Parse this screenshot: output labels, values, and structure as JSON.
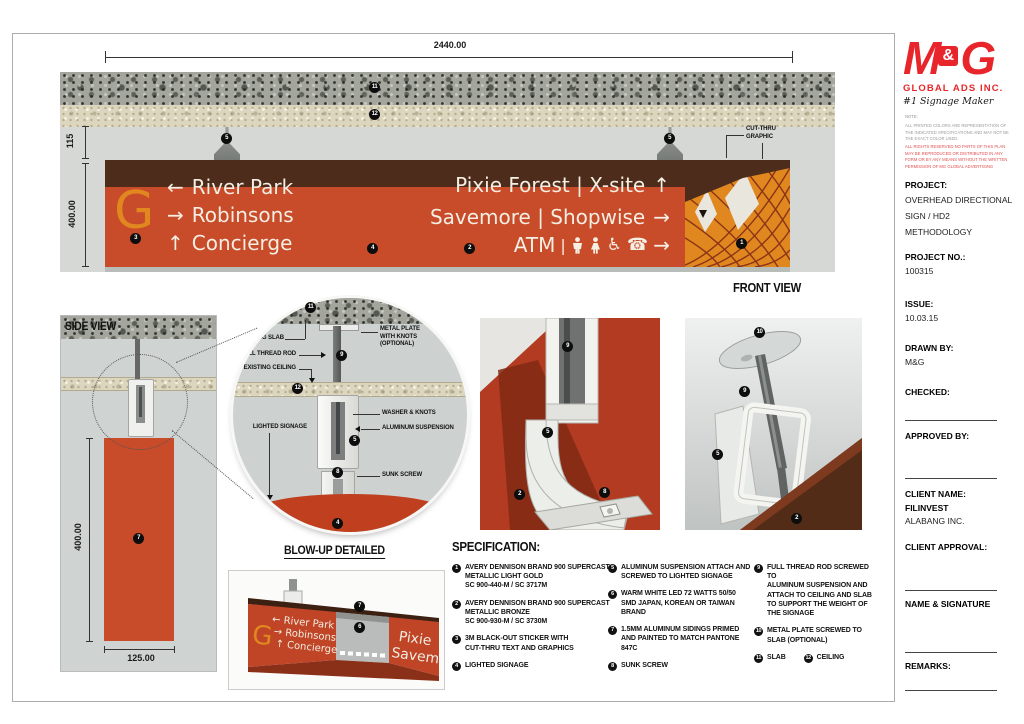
{
  "colors": {
    "sign_orange": "#c84b2a",
    "sign_brown": "#4e2c1b",
    "accent_orange": "#e1871f",
    "detail_red": "#b23b21",
    "logo_red": "#e8252a"
  },
  "front_view": {
    "dim_width": "2440.00",
    "dim_gap": "115",
    "dim_height": "400.00",
    "cut_thru": "CUT-THRU\nGRAPHIC",
    "label": "FRONT VIEW",
    "g_letter": "G",
    "rows_left": [
      {
        "arrow": "←",
        "label": "River Park"
      },
      {
        "arrow": "→",
        "label": "Robinsons"
      },
      {
        "arrow": "↑",
        "label": "Concierge"
      }
    ],
    "rows_right": [
      {
        "label": "Pixie Forest | X-site",
        "arrow": "↑"
      },
      {
        "label": "Savemore | Shopwise",
        "arrow": "→"
      }
    ],
    "atm": {
      "label": "ATM",
      "divider": "|",
      "icons": [
        "man-icon",
        "woman-icon",
        "wheelchair-icon",
        "phone-icon"
      ],
      "wheelchair_glyph": "♿",
      "phone_glyph": "☎",
      "arrow": "→"
    }
  },
  "side_view": {
    "label": "SIDE VIEW",
    "dim_height": "400.00",
    "dim_depth": "125.00"
  },
  "blowup": {
    "title": "BLOW-UP DETAILED",
    "existing_slab": "EXISTING SLAB",
    "full_thread_rod": "FULL THREAD ROD",
    "existing_ceiling": "EXISTING CEILING",
    "lighted_signage": "LIGHTED SIGNAGE",
    "metal_plate": "METAL PLATE\nWITH KNOTS\n(OPTIONAL)",
    "washer": "WASHER & KNOTS",
    "aluminum_suspension": "ALUMINUM SUSPENSION",
    "sunk_screw": "SUNK SCREW"
  },
  "perspective": {
    "g": "G",
    "row1": "← River Park",
    "row2": "→ Robinsons",
    "row3": "↑ Concierge",
    "right1": "Pixie",
    "right2": "Savem"
  },
  "specification": {
    "title": "SPECIFICATION:",
    "items": [
      {
        "num": "1",
        "text": "AVERY DENNISON BRAND 900 SUPERCAST\nMETALLIC LIGHT GOLD\nSC 900-440-M / SC 3717M"
      },
      {
        "num": "2",
        "text": "AVERY DENNISON BRAND 900 SUPERCAST\nMETALLIC BRONZE\nSC 900-930-M / SC 3730M"
      },
      {
        "num": "3",
        "text": "3M BLACK-OUT STICKER WITH\nCUT-THRU TEXT AND GRAPHICS"
      },
      {
        "num": "4",
        "text": "LIGHTED SIGNAGE"
      },
      {
        "num": "5",
        "text": "ALUMINUM SUSPENSION ATTACH AND\nSCREWED TO LIGHTED SIGNAGE"
      },
      {
        "num": "6",
        "text": "WARM WHITE LED 72 WATTS 50/50\nSMD JAPAN, KOREAN OR TAIWAN\nBRAND"
      },
      {
        "num": "7",
        "text": "1.5MM ALUMINUM SIDINGS PRIMED\nAND PAINTED TO MATCH PANTONE\n847C"
      },
      {
        "num": "8",
        "text": "SUNK SCREW"
      },
      {
        "num": "9",
        "text": "FULL THREAD ROD SCREWED TO\nALUMINUM SUSPENSION AND\nATTACH TO CEILING AND SLAB\nTO SUPPORT THE WEIGHT OF\nTHE SIGNAGE"
      },
      {
        "num": "10",
        "text": "METAL PLATE SCREWED TO\nSLAB (OPTIONAL)"
      }
    ],
    "item11": {
      "num": "11",
      "text": "SLAB"
    },
    "item12": {
      "num": "12",
      "text": "CEILING"
    }
  },
  "markers": {
    "1": "1",
    "2": "2",
    "3": "3",
    "4": "4",
    "5": "5",
    "6": "6",
    "7": "7",
    "8": "8",
    "9": "9",
    "10": "10",
    "11": "11",
    "12": "12"
  },
  "sidebar": {
    "logo": {
      "m": "M",
      "amp": "&",
      "g": "G",
      "company": "GLOBAL ADS INC.",
      "tagline": "#1 Signage Maker"
    },
    "note_label": "NOTE:",
    "note1": "ALL PRINTED COLORS ARE REPRESENTATION OF THE INDICATED SPECIFICATIONS AND MAY NOT BE THE EXACT COLOR USED.",
    "note2": "ALL RIGHTS RESERVED NO PARTS OF THIS PLAN MAY BE REPRODUCED OR DISTRIBUTED IN ANY FORM OR BY ANY MEANS WITHOUT THE WRITTEN PERMISSION OF MG GLOBAL ADVERTISING",
    "project_label": "PROJECT:",
    "project_value": "OVERHEAD DIRECTIONAL\nSIGN / HD2\nMETHODOLOGY",
    "project_no_label": "PROJECT NO.:",
    "project_no_value": "100315",
    "issue_label": "ISSUE:",
    "issue_value": "10.03.15",
    "drawn_label": "DRAWN BY:",
    "drawn_value": "M&G",
    "checked_label": "CHECKED:",
    "approved_label": "APPROVED BY:",
    "client_label": "CLIENT NAME:",
    "client_value1": "FILINVEST",
    "client_value2": "ALABANG INC.",
    "approval_label": "CLIENT APPROVAL:",
    "name_sig_label": "NAME & SIGNATURE",
    "remarks_label": "REMARKS:"
  }
}
